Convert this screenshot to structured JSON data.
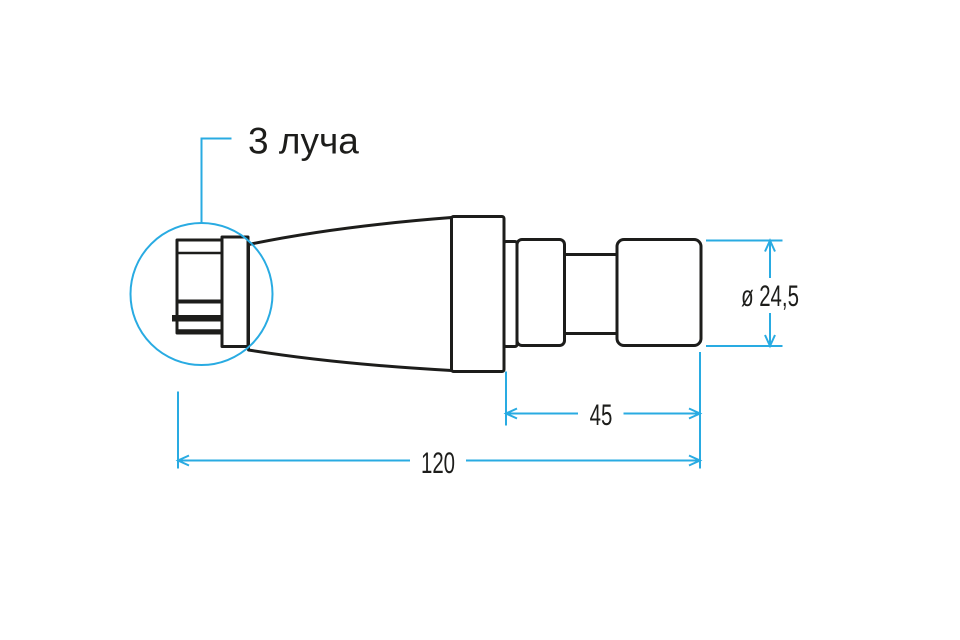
{
  "drawing": {
    "callout_label": "3 луча",
    "dimensions": {
      "diameter": "ø 24,5",
      "front_length": "45",
      "total_length": "120"
    }
  },
  "colors": {
    "ink": "#1d1d1b",
    "accent": "#29abe2",
    "background": "#ffffff"
  }
}
